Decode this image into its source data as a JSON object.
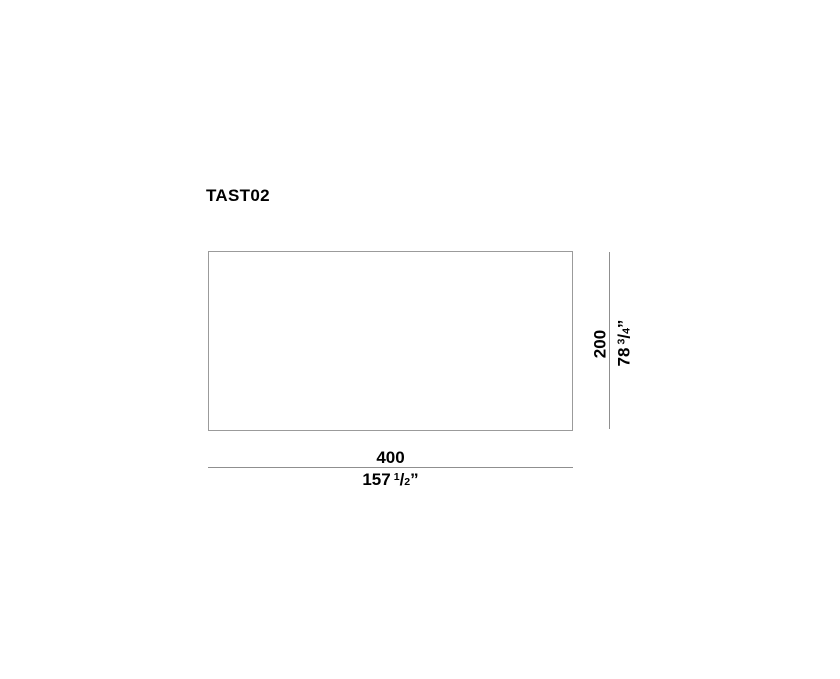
{
  "drawing": {
    "title": "TAST02",
    "width_dimension": {
      "metric": "400",
      "imperial": {
        "whole": "157",
        "numerator": "1",
        "fraction_slash": "/",
        "denominator": "2",
        "inch_mark": "”"
      }
    },
    "height_dimension": {
      "metric": "200",
      "imperial": {
        "whole": "78",
        "numerator": "3",
        "fraction_slash": "/",
        "denominator": "4",
        "inch_mark": "”"
      }
    }
  },
  "colors": {
    "background": "#ffffff",
    "outline": "#9b9b9b",
    "dimension_line": "#8f8f8f",
    "text": "#000000"
  }
}
